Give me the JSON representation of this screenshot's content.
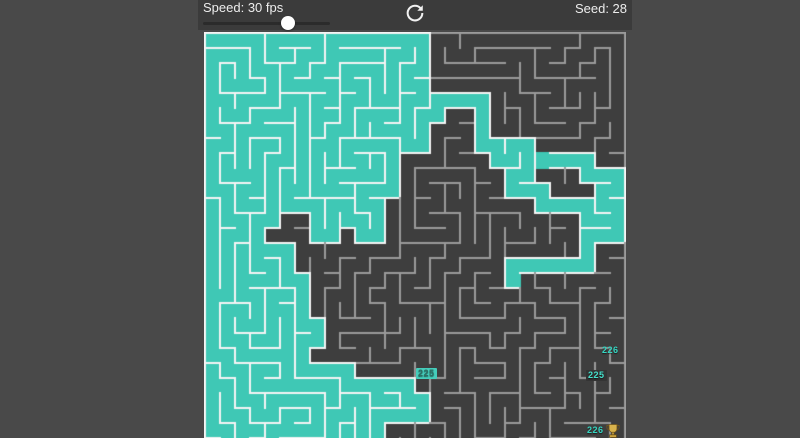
{
  "toolbar": {
    "speed_label": "Speed: 30 fps",
    "speed_value": 30,
    "speed_unit": "fps",
    "refresh_icon": "circular-refresh-arrow",
    "seed_label": "Seed: 28",
    "seed_value": 28
  },
  "maze": {
    "cols": 28,
    "rows": 28,
    "cell_px": 15,
    "seed": 28,
    "flood_limit": 226,
    "colors": {
      "page_bg": "#494949",
      "toolbar_bg": "#3b3b3b",
      "dark_cell": "#3e3e3e",
      "flood_teal": "#3fc8b5",
      "wall_light": "#f4f4f4",
      "wall_dim": "#9a9a9a",
      "label_teal": "#35d6c2",
      "label_dark": "#2c6e63"
    },
    "labels": [
      {
        "text": "226",
        "x": 396,
        "y": 313,
        "fg": "#35d6c2",
        "bg": "none"
      },
      {
        "text": "225",
        "x": 382,
        "y": 338,
        "fg": "#45e0cc",
        "bg": "#343434"
      },
      {
        "text": "225",
        "x": 212,
        "y": 336,
        "fg": "#2c6e63",
        "bg": "#45cdbb"
      },
      {
        "text": "226",
        "x": 381,
        "y": 393,
        "fg": "#35d6c2",
        "bg": "none"
      }
    ],
    "goal": {
      "icon": "trophy-icon",
      "x": 401,
      "y": 391
    }
  }
}
